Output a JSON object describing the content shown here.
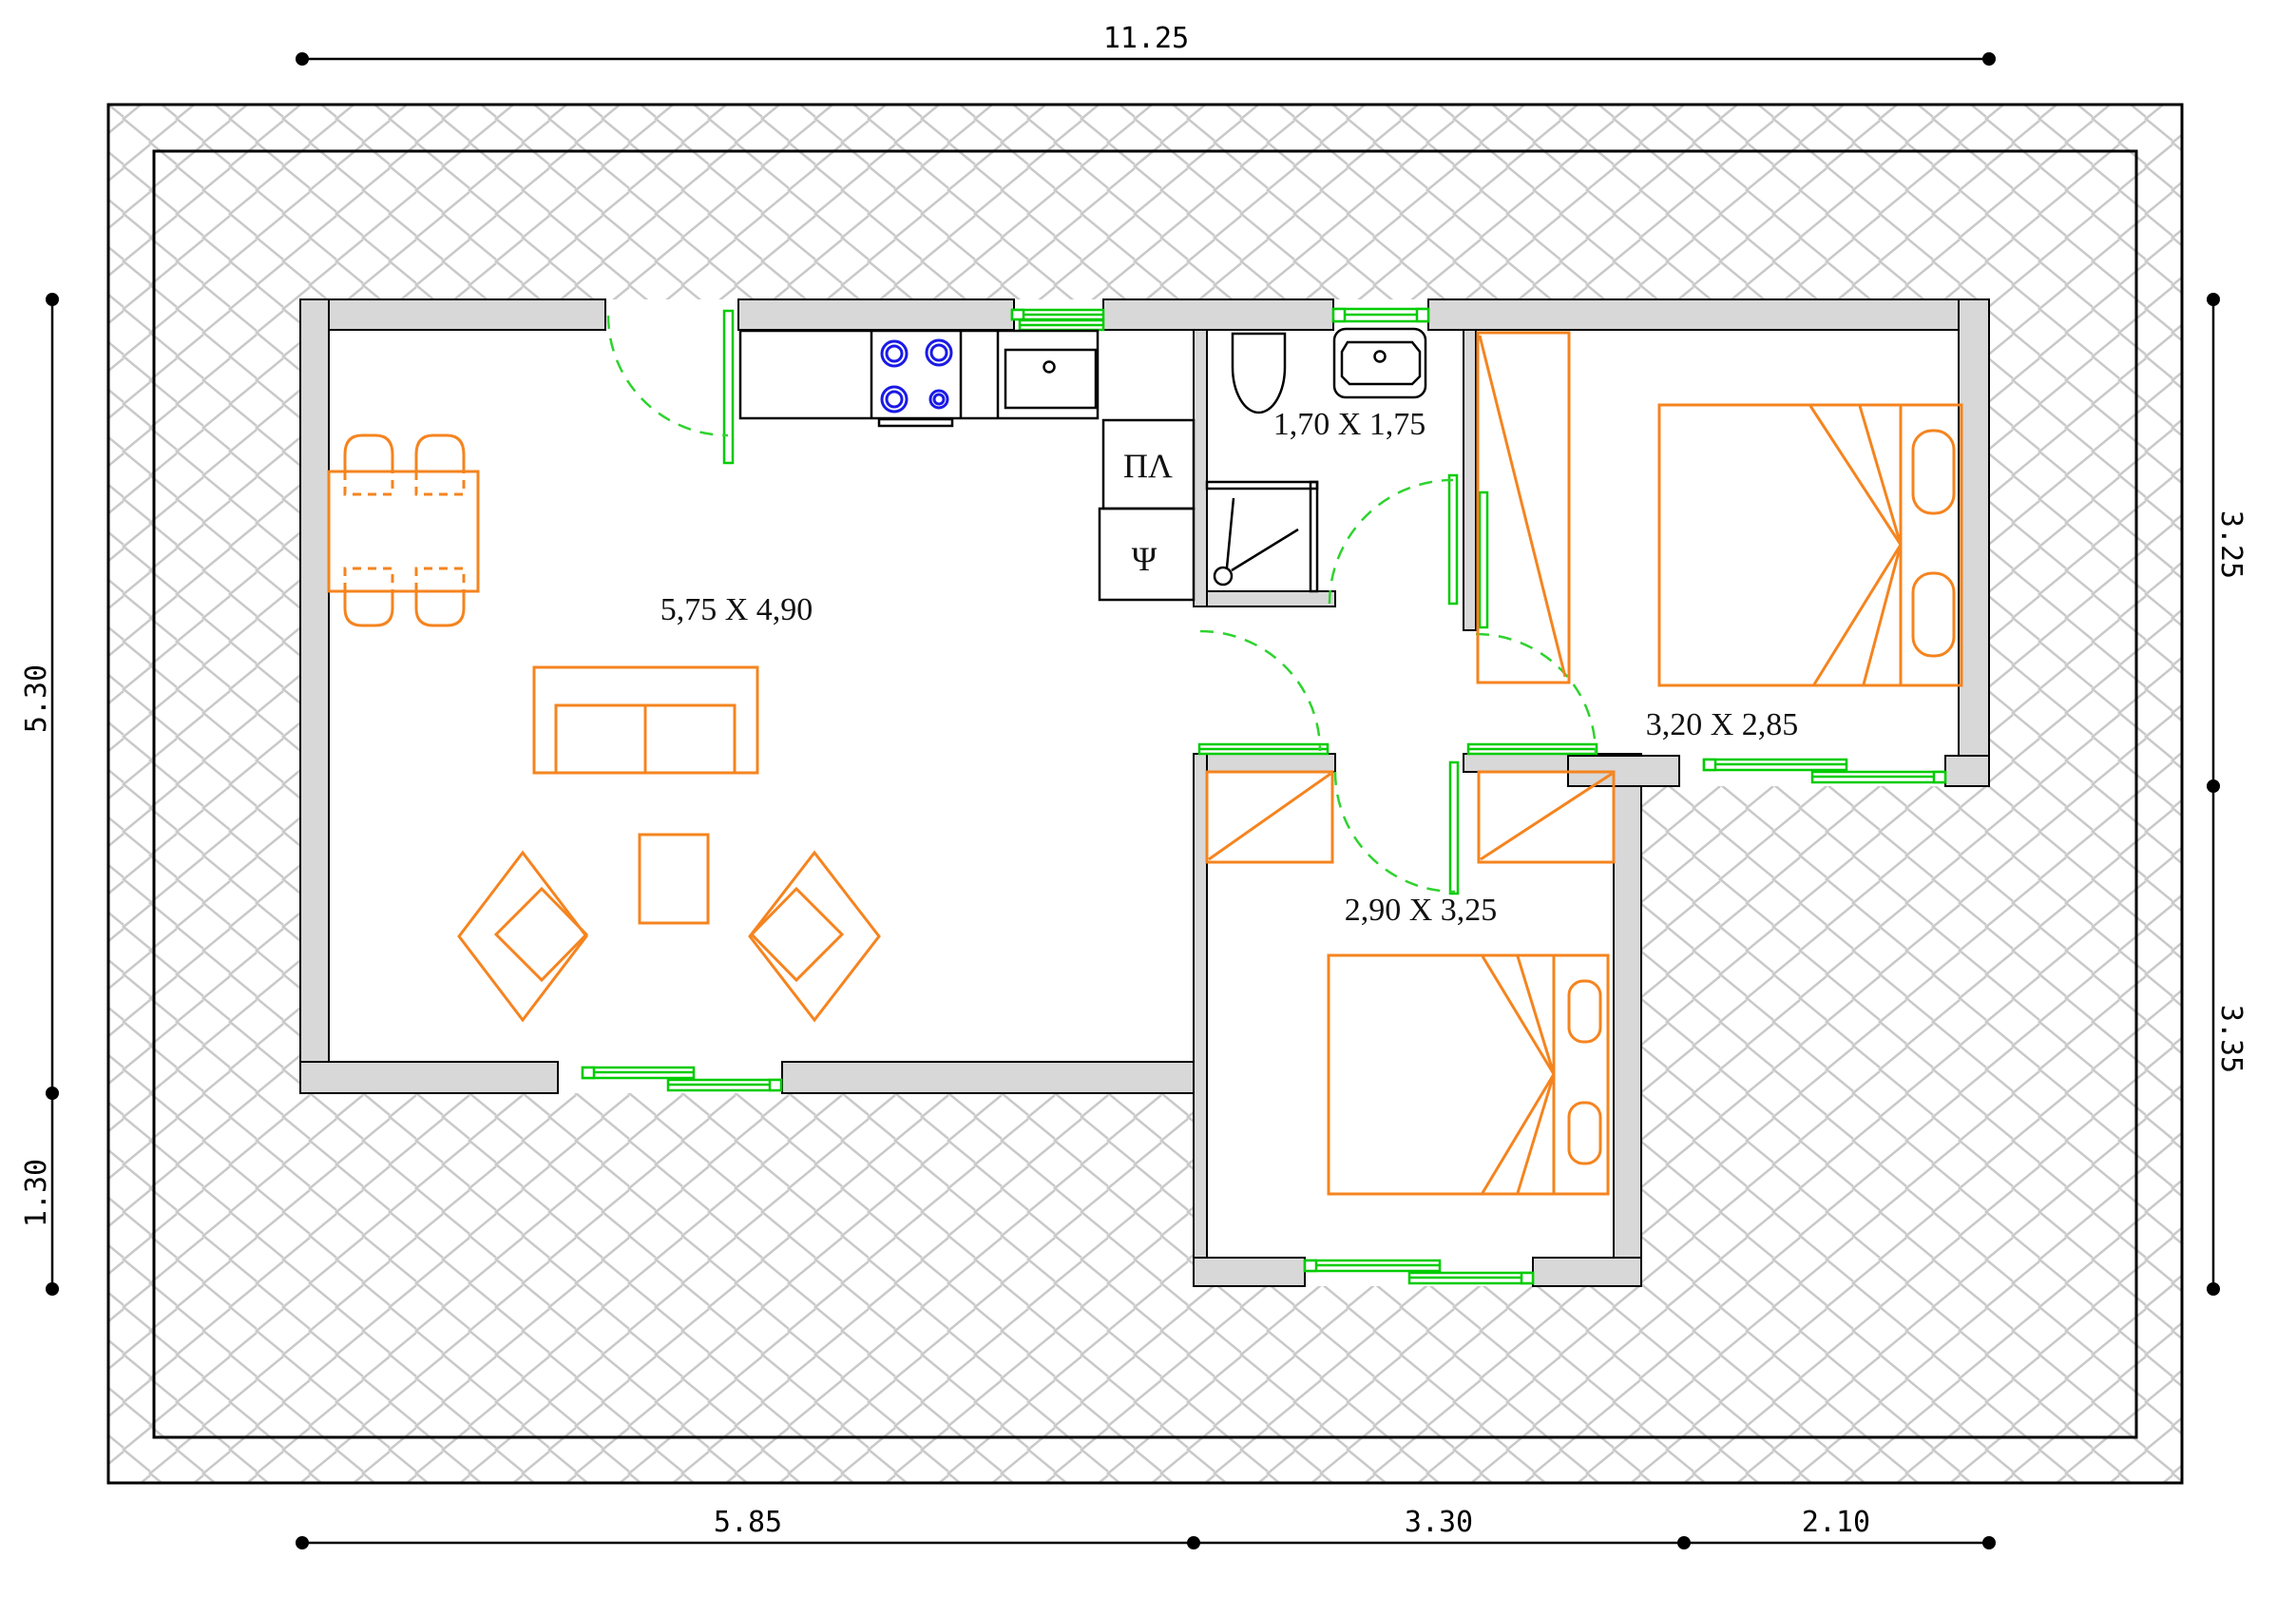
{
  "plan": {
    "dimensions": {
      "top": "11.25",
      "left": [
        "5.30",
        "1.30"
      ],
      "right": [
        "3.25",
        "3.35"
      ],
      "bottom": [
        "5.85",
        "3.30",
        "2.10"
      ]
    },
    "rooms": {
      "living_room": "5,75 X 4,90",
      "bathroom": "1,70 X 1,75",
      "bedroom_right": "3,20 X 2,85",
      "bedroom_bottom": "2,90 X 3,25"
    },
    "appliances": {
      "washing_machine": "ΠΛ",
      "refrigerator": "Ψ"
    },
    "colors": {
      "furniture": "#f5841f",
      "openings": "#00cc00",
      "burners": "#1a1ae6",
      "walls": "#d8d8d8",
      "hatch": "#c9c9c9"
    }
  }
}
